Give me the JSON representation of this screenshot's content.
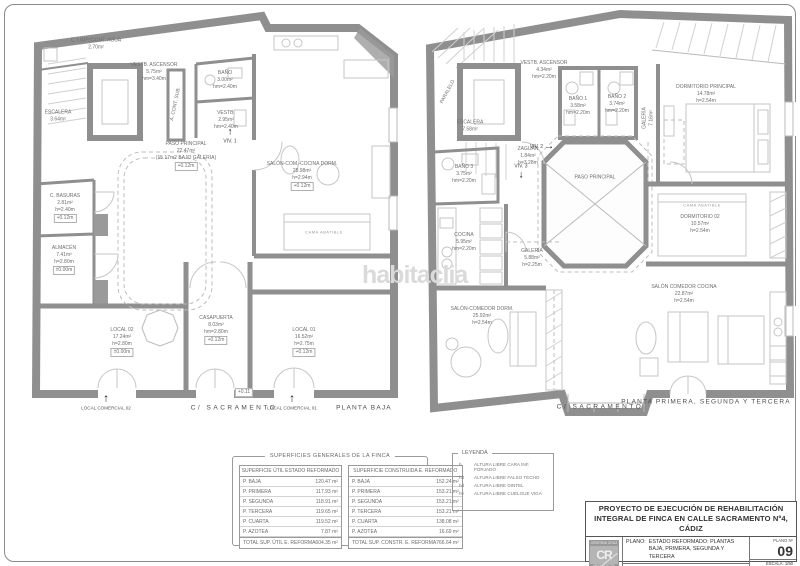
{
  "sheet": {
    "watermark": "habitaclia"
  },
  "plans": [
    {
      "id": "planta-baja",
      "rooms": [
        {
          "name": "C. LIMP./CONT. AGUA",
          "area": "2.70m²",
          "x": 68,
          "y": 36
        },
        {
          "name": "VESTB. ASCENSOR",
          "area": "5.75m²",
          "height": "hm=3.40m",
          "x": 126,
          "y": 64
        },
        {
          "name": "ESCALERA",
          "area": "3.64m²",
          "x": 30,
          "y": 108
        },
        {
          "name": "BAÑO",
          "area": "3.00m²",
          "height": "hm=2.40m",
          "x": 197,
          "y": 72
        },
        {
          "name": "VESTB.",
          "area": "2.95m²",
          "height": "hm=2.40m",
          "x": 198,
          "y": 112
        },
        {
          "name": "A. CONT. SUB.",
          "x": 148,
          "y": 96,
          "rot": -78
        },
        {
          "name": "PASO PRINCIPAL",
          "area": "22.47m²",
          "sub": "(15.17m2 BAJO GALERIA)",
          "elev": "+0.12m",
          "x": 158,
          "y": 148
        },
        {
          "name": "SALÓN-COM.-COCINA DORM.",
          "area": "28.98m²",
          "height": "h=2.94m",
          "elev": "+0.12m",
          "x": 274,
          "y": 168
        },
        {
          "name": "CAMA ABATIBLE",
          "x": 296,
          "y": 224,
          "cls": "furntext"
        },
        {
          "name": "C. BASURAS",
          "area": "2.81m²",
          "height": "h=2.40m",
          "elev": "+0.12m",
          "x": 37,
          "y": 200
        },
        {
          "name": "ALMACÉN",
          "area": "7.41m²",
          "height": "h=2.80m",
          "elev": "±0.00m",
          "x": 36,
          "y": 252
        },
        {
          "name": "LOCAL 02",
          "area": "17.24m²",
          "height": "h=2.80m",
          "elev": "±0.00m",
          "x": 94,
          "y": 334
        },
        {
          "name": "CASAPUERTA",
          "area": "8.03m²",
          "height": "hm=2.80m",
          "elev": "+0.12m",
          "x": 188,
          "y": 322
        },
        {
          "name": "LOCAL 01",
          "area": "16.52m²",
          "height": "h=2.75m",
          "elev": "+0.12m",
          "x": 276,
          "y": 334
        },
        {
          "elev": "+0.11",
          "x": 216,
          "y": 384
        }
      ],
      "markers": [
        {
          "label": "VIV. 1",
          "arrow": "↑",
          "x": 202,
          "y": 128,
          "cls": "col"
        }
      ],
      "captions": [
        {
          "text": "LOCAL COMERCIAL 02",
          "arrow": "↑",
          "x": 78,
          "y": 394,
          "cls": "col"
        },
        {
          "text": "C/ SACRAMENTO",
          "x": 206,
          "y": 400,
          "cls": "street"
        },
        {
          "text": "LOCAL COMERCIAL 01",
          "arrow": "↑",
          "x": 264,
          "y": 394,
          "cls": "col"
        },
        {
          "text": "PLANTA BAJA",
          "x": 336,
          "y": 400,
          "cls": "caption"
        }
      ]
    },
    {
      "id": "planta-primera-segunda-tercera",
      "rooms": [
        {
          "name": "PARALELO",
          "x": 30,
          "y": 86,
          "rot": -62
        },
        {
          "name": "VESTB. ASCENSOR",
          "area": "4.34m²",
          "height": "hm=2.20m",
          "x": 126,
          "y": 64
        },
        {
          "name": "BAÑO 1",
          "area": "3.58m²",
          "height": "hm=2.20m",
          "x": 160,
          "y": 100
        },
        {
          "name": "BAÑO 2",
          "area": "3.74m²",
          "height": "hm=2.20m",
          "x": 199,
          "y": 98
        },
        {
          "name": "ESCALERA",
          "area": "7.58m²",
          "x": 52,
          "y": 120
        },
        {
          "name": "ZAGUÁN",
          "area": "1.84m²",
          "height": "h=3.28m",
          "x": 110,
          "y": 150
        },
        {
          "name": "PASO PRINCIPAL",
          "x": 177,
          "y": 172
        },
        {
          "name": "BAÑO 3",
          "area": "3.75m²",
          "height": "hm=2.20m",
          "x": 46,
          "y": 168
        },
        {
          "name": "COCINA",
          "area": "5.95m²",
          "height": "hm=2.20m",
          "x": 46,
          "y": 236
        },
        {
          "name": "GALERÍA",
          "area": "5.88m²",
          "height": "h=2.25m",
          "x": 114,
          "y": 252
        },
        {
          "name": "GALERÍA",
          "area": "7.16m²",
          "x": 230,
          "y": 112,
          "rot": -90
        },
        {
          "name": "DORMITORIO PRINCIPAL",
          "area": "14.78m²",
          "height": "h=2.54m",
          "x": 288,
          "y": 88
        },
        {
          "name": "CAMA ABATIBLE",
          "x": 284,
          "y": 199,
          "cls": "furntext"
        },
        {
          "name": "DORMITORIO 02",
          "area": "10.57m²",
          "height": "h=2.54m",
          "x": 282,
          "y": 218
        },
        {
          "name": "SALÓN-COMEDOR DORM.",
          "area": "25.92m²",
          "height": "h=2.54m",
          "x": 64,
          "y": 310
        },
        {
          "name": "SALÓN COMEDOR COCINA",
          "area": "22.87m²",
          "height": "h=2.54m",
          "x": 266,
          "y": 288
        }
      ],
      "markers": [
        {
          "label": "VIV. 2",
          "arrow": "→",
          "x": 124,
          "y": 141,
          "cls": "rowrev"
        },
        {
          "label": "VIV. 3",
          "arrow": "↓",
          "x": 103,
          "y": 166,
          "cls": "colrev"
        }
      ],
      "captions": [
        {
          "text": "C/ SACRAMENTO",
          "x": 182,
          "y": 401,
          "cls": "street"
        },
        {
          "text": "PLANTA PRIMERA, SEGUNDA Y TERCERA",
          "x": 288,
          "y": 396,
          "cls": "caption"
        }
      ]
    }
  ],
  "summary": {
    "title": "SUPERFICIES GENERALES DE LA FINCA",
    "tables": [
      {
        "header": "SUPERFICIE ÚTIL ESTADO REFORMADO",
        "rows": [
          [
            "P. BAJA",
            "120.47 m²"
          ],
          [
            "P. PRIMERA",
            "117.93 m²"
          ],
          [
            "P. SEGUNDA",
            "118.91 m²"
          ],
          [
            "P. TERCERA",
            "119.65 m²"
          ],
          [
            "P. CUARTA",
            "119.52 m²"
          ],
          [
            "P. AZOTEA",
            "7.87 m²"
          ]
        ],
        "total_label": "TOTAL SUP. ÚTIL E. REFORMA",
        "total_value": "604.35 m²"
      },
      {
        "header": "SUPERFICIE CONSTRUIDA E. REFORMADO",
        "rows": [
          [
            "P. BAJA",
            "152.24 m²"
          ],
          [
            "P. PRIMERA",
            "153.21 m²"
          ],
          [
            "P. SEGUNDA",
            "153.21 m²"
          ],
          [
            "P. TERCERA",
            "153.21 m²"
          ],
          [
            "P. CUARTA",
            "138.08 m²"
          ],
          [
            "P. AZOTEA",
            "16.69 m²"
          ]
        ],
        "total_label": "TOTAL SUP. CONSTR. E. REFORMA",
        "total_value": "766.64 m²"
      }
    ]
  },
  "legend": {
    "title": "LEYENDA",
    "items": [
      [
        "h",
        "ALTURA LIBRE CARA INF. FORJADO"
      ],
      [
        "hft",
        "ALTURA LIBRE FALSO TECHO"
      ],
      [
        "hd",
        "ALTURA LIBRE DINTEL"
      ],
      [
        "hv",
        "ALTURA LIBRE CUELGUE VIGA"
      ]
    ]
  },
  "titleblock": {
    "project_title": "PROYECTO DE EJECUCIÓN DE REHABILITACIÓN INTEGRAL DE FINCA EN CALLE SACRAMENTO Nº4, CÁDIZ",
    "logo_top": "CRISTINA CRUZ",
    "logo_initials": "CR",
    "logo_bottom": "ARQUITECTA",
    "plano_label": "PLANO:",
    "plano_value": "ESTADO REFORMADO: PLANTAS\nBAJA, PRIMERA, SEGUNDA Y TERCERA",
    "promotor": "PROMOTOR: PROMOCIONES OLIVARES 2022 S.L.",
    "arquitecto": "ARQUITECTO: CRISTINA CRUZ NAVAS, Arq. Coleg. 503 COA CÁDIZ",
    "plano_num_label": "PLANO Nº",
    "plano_num": "09",
    "escala": "ESCALA: 1/50",
    "fecha": "ENERO 2023"
  }
}
